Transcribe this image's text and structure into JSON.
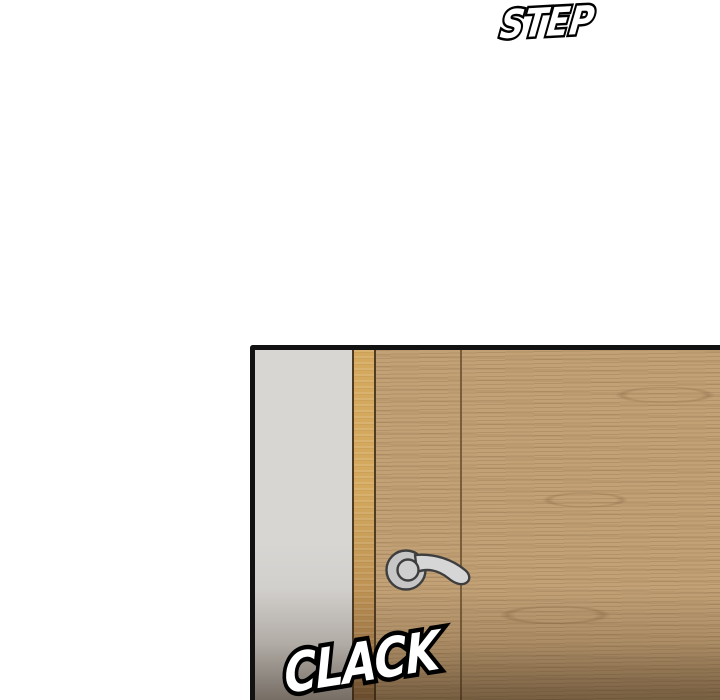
{
  "sfx": {
    "step": {
      "text": "STEP",
      "fill": "#ffffff",
      "outline": "#000000"
    },
    "clack": {
      "text": "CLACK",
      "fill": "#ffffff",
      "outline": "#000000"
    }
  },
  "panel": {
    "border_color": "#121212",
    "wall_color": "#d8d6d3",
    "wall_color_dark": "#c2c0bd",
    "frame_color_top": "#d4a95e",
    "frame_color_bottom": "#a67a4a",
    "frame_edge_color": "#4f3a22",
    "door_color": "#c2a176",
    "door_seam_color": "#6d5232",
    "grain_line": "rgba(122,90,56,0.22)",
    "grain_band": "rgba(110,82,52,0.10)",
    "knot_color": "rgba(122,90,56,0.28)",
    "handle_fill": "#c6c6c6",
    "handle_lever_fill": "#d6d6d6",
    "handle_collar_fill": "#cfcfcf",
    "handle_outline": "#3e3e3e",
    "shadow_mid": "rgba(62,42,22,0.18)",
    "shadow_end": "rgba(44,29,14,0.5)"
  }
}
